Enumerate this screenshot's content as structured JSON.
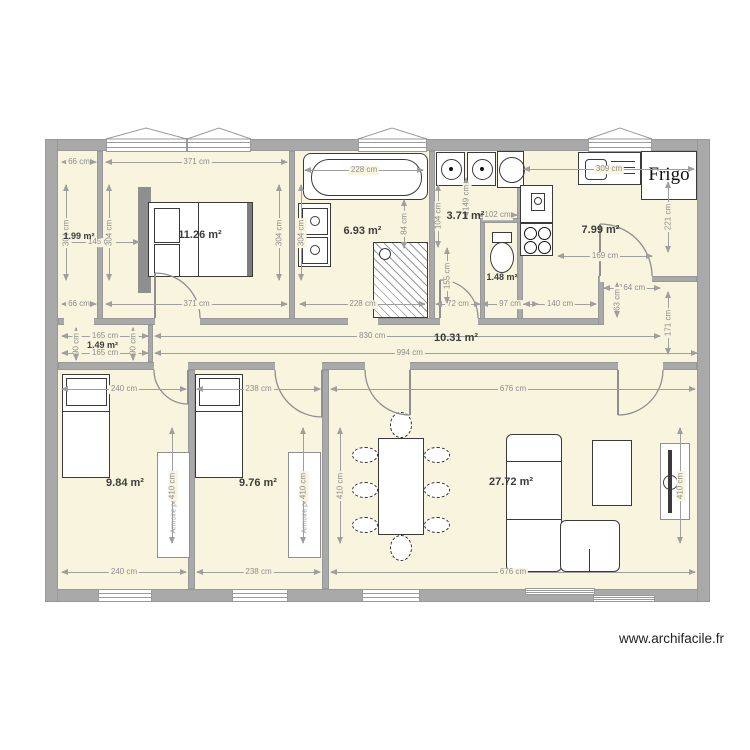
{
  "credit": "www.archifacile.fr",
  "palette": {
    "wall": "#a9a9a9",
    "floor": "#f8f4dd",
    "dimension": "#9f9f9f",
    "label": "#3d3d3d",
    "furniture_line": "#3a3a3a"
  },
  "rooms": {
    "closet": "1.99 m²",
    "bedroom": "11.26 m²",
    "bathroom": "6.93 m²",
    "laundry": "3.71 m²",
    "wc": "1.48 m²",
    "kitchen": "7.99 m²",
    "entry": "1.49 m²",
    "hallway": "10.31 m²",
    "bedroom2": "9.84 m²",
    "bedroom3": "9.76 m²",
    "living": "27.72 m²"
  },
  "furniture": {
    "fridge": "Frigo",
    "wardrobe2": "Armoire penderie",
    "wardrobe3": "Armoire penderie"
  },
  "dims": {
    "closet_top": "66 cm",
    "closet_bottom": "66 cm",
    "closet_height": "304 cm",
    "bedroom_top": "371 cm",
    "bedroom_bottom": "371 cm",
    "bedroom_height_left": "304 cm",
    "bedroom_height_right": "304 cm",
    "entry_to_bed": "145 cm",
    "bath_top": "228 cm",
    "bath_bottom": "228 cm",
    "bath_height": "304 cm",
    "tub_side": "84 cm",
    "laundry_width": "102 cm",
    "laundry_height": "104 cm",
    "wc_height": "155 cm",
    "appliance_height": "149 cm",
    "corridor_width": "72 cm",
    "wc_width": "97 cm",
    "kitchen_top": "309 cm",
    "kitchen_left": "140 cm",
    "kitchen_door": "169 cm",
    "kitchen_nook_width": "164 cm",
    "kitchen_nook_height": "63 cm",
    "kitchen_height_right": "221 cm",
    "hall_right_height": "171 cm",
    "entry_width_top": "165 cm",
    "entry_width_bottom": "165 cm",
    "entry_height_left": "90 cm",
    "entry_height_right": "90 cm",
    "hall_length": "830 cm",
    "total_length": "994 cm",
    "bedroom2_top": "240 cm",
    "bedroom2_bottom": "240 cm",
    "bedroom3_top": "238 cm",
    "bedroom3_bottom": "238 cm",
    "living_top": "676 cm",
    "living_bottom": "676 cm",
    "bedroom2_height": "410 cm",
    "bedroom3_height": "410 cm",
    "living_height_left": "410 cm",
    "living_height_right": "410 cm"
  }
}
